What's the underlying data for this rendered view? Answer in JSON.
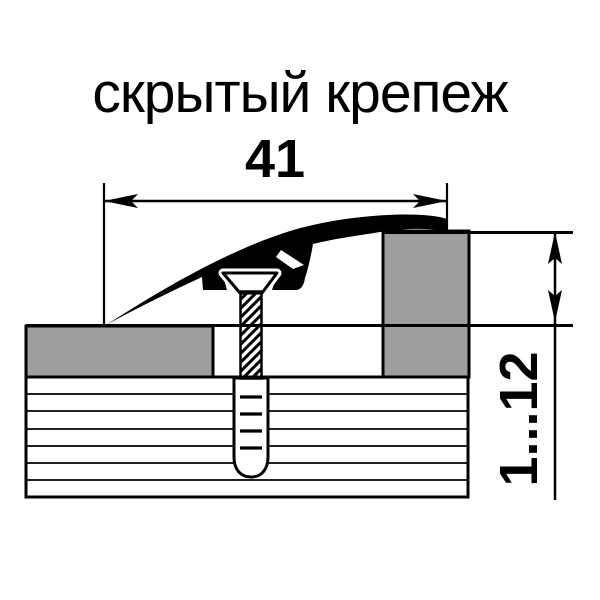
{
  "title": "скрытый крепеж",
  "dimensions": {
    "width": {
      "label": "41"
    },
    "height": {
      "label": "1...12"
    }
  },
  "colors": {
    "line": "#000000",
    "floor_gray": "#9e9e9e",
    "background": "#ffffff"
  }
}
